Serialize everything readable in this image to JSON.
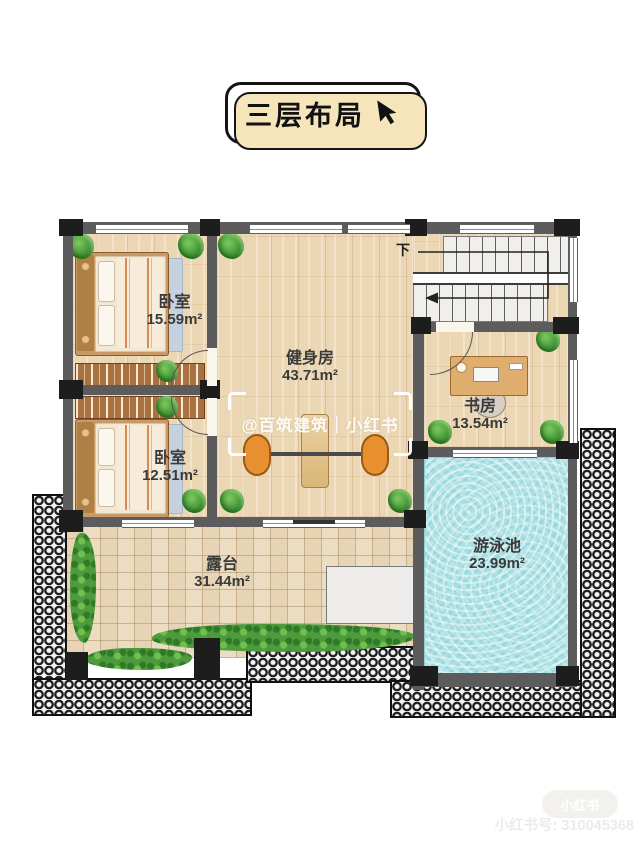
{
  "title_badge": {
    "label": "三层布局",
    "cursor_icon": "cursor-arrow-icon"
  },
  "rooms": [
    {
      "name": "卧室",
      "area": "15.59m²"
    },
    {
      "name": "健身房",
      "area": "43.71m²"
    },
    {
      "name": "书房",
      "area": "13.54m²"
    },
    {
      "name": "卧室",
      "area": "12.51m²"
    },
    {
      "name": "露台",
      "area": "31.44m²"
    },
    {
      "name": "游泳池",
      "area": "23.99m²"
    }
  ],
  "stairs": {
    "direction_label": "下"
  },
  "center_watermark": {
    "text": "@百筑建筑｜小红书"
  },
  "footer_watermark": {
    "logo": "小红书",
    "account_line": "小红书号: 310045368"
  },
  "colors": {
    "wall": "#5c5c5c",
    "wood_floor": "#ecd7b4",
    "terrace_tile": "#ecddc2",
    "pool_water": "#a9dfe2",
    "hedge_green": "#4e9b3e",
    "badge_shadow": "#f6e5bb",
    "weight_plate_orange": "#e89030"
  }
}
